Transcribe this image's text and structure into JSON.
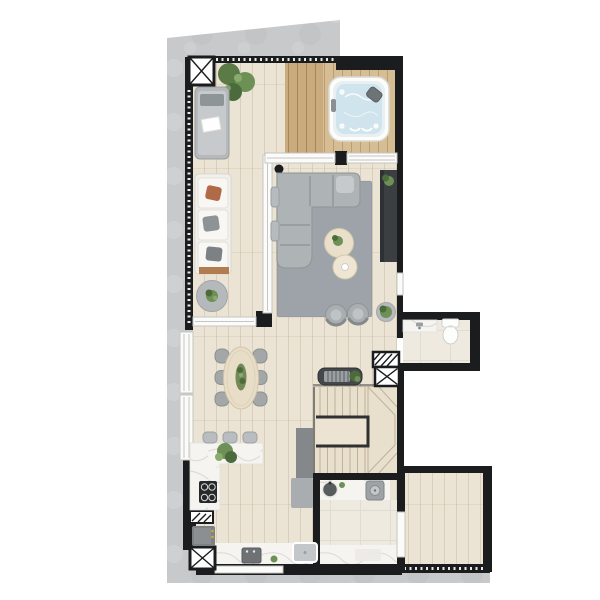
{
  "canvas": {
    "width": 600,
    "height": 600
  },
  "palette": {
    "page_bg": "#ffffff",
    "wall": "#1b1c1e",
    "concrete": "#c7c9cb",
    "concrete_light": "#d3d5d7",
    "wood": "#ebe3d3",
    "wood_line": "#d9cdb8",
    "deck": "#d6bd93",
    "deck_dark": "#c9ab7d",
    "glass": "#fbfbfa",
    "frame": "#c6c6c2",
    "rug": "#9da3a8",
    "sofa": "#aeb3b6",
    "white_sofa": "#f1f0ec",
    "marble": "#f5f4f1",
    "vein": "#d9d9d4",
    "tile": "#efeadf",
    "stair": "#e8dfcc",
    "stair_line": "#bfb29a",
    "plant": "#6d9055",
    "plant_dark": "#4c6b3c",
    "water": "#cfe4ec",
    "tv": "#3c3f42",
    "table_wood": "#e8ddc7",
    "chair": "#a3a7a8",
    "appliance": "#9fa3a6",
    "rust": "#b06a48",
    "gold": "#c9a44a"
  },
  "plan": {
    "view": "top-down-floor-plan",
    "rooms": [
      "terrace",
      "balcony",
      "spa-deck",
      "living-room",
      "dining-area",
      "kitchen",
      "hallway",
      "bathroom",
      "service-bathroom",
      "staircase",
      "side-room"
    ],
    "fixtures": [
      "hot-tub",
      "chaise-lounge",
      "outdoor-sofa",
      "side-table-with-plant",
      "planters",
      "sectional-sofa",
      "area-rug",
      "nesting-coffee-tables",
      "lounge-chairs",
      "tv-panel",
      "console-sideboard",
      "pendant-column",
      "dining-table",
      "dining-centerpiece",
      "kitchen-counter",
      "bar-stools",
      "cooktop",
      "oven",
      "vent-box",
      "kitchen-sink",
      "shower",
      "laundry-sink",
      "washer",
      "bathroom-vanity",
      "toilet",
      "shaft-box",
      "duct-box",
      "u-shaped-stairs"
    ],
    "counts": {
      "dining_chairs": 6,
      "bar_stools": 3,
      "lounge_chairs": 2,
      "coffee_tables": 2,
      "shaft_boxes": 2,
      "duct_boxes": 2,
      "windows": 2,
      "hot_tubs": 1
    }
  }
}
